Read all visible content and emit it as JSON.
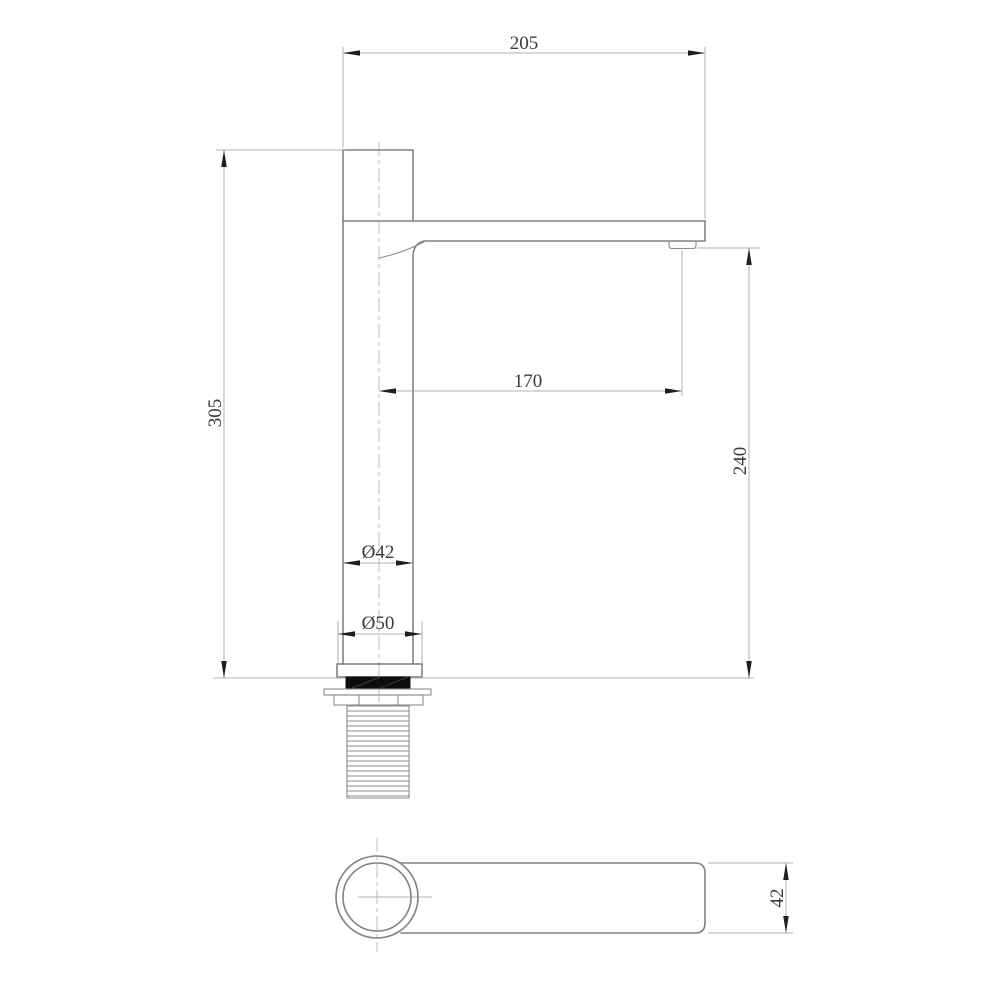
{
  "drawing": {
    "colors": {
      "background": "#ffffff",
      "object_line": "#828282",
      "dimension_line": "#b2b2b2",
      "centerline": "#bcbcbc",
      "arrow": "#1f1f1f",
      "text": "#3a3a3a",
      "gasket_fill": "#0d0d0d"
    },
    "front_view": {
      "dims": {
        "overall_width": "205",
        "overall_height": "305",
        "spout_reach": "170",
        "spout_height": "240",
        "body_diameter": "Ø42",
        "base_diameter": "Ø50"
      }
    },
    "top_view": {
      "dims": {
        "handle_width": "42"
      }
    }
  }
}
